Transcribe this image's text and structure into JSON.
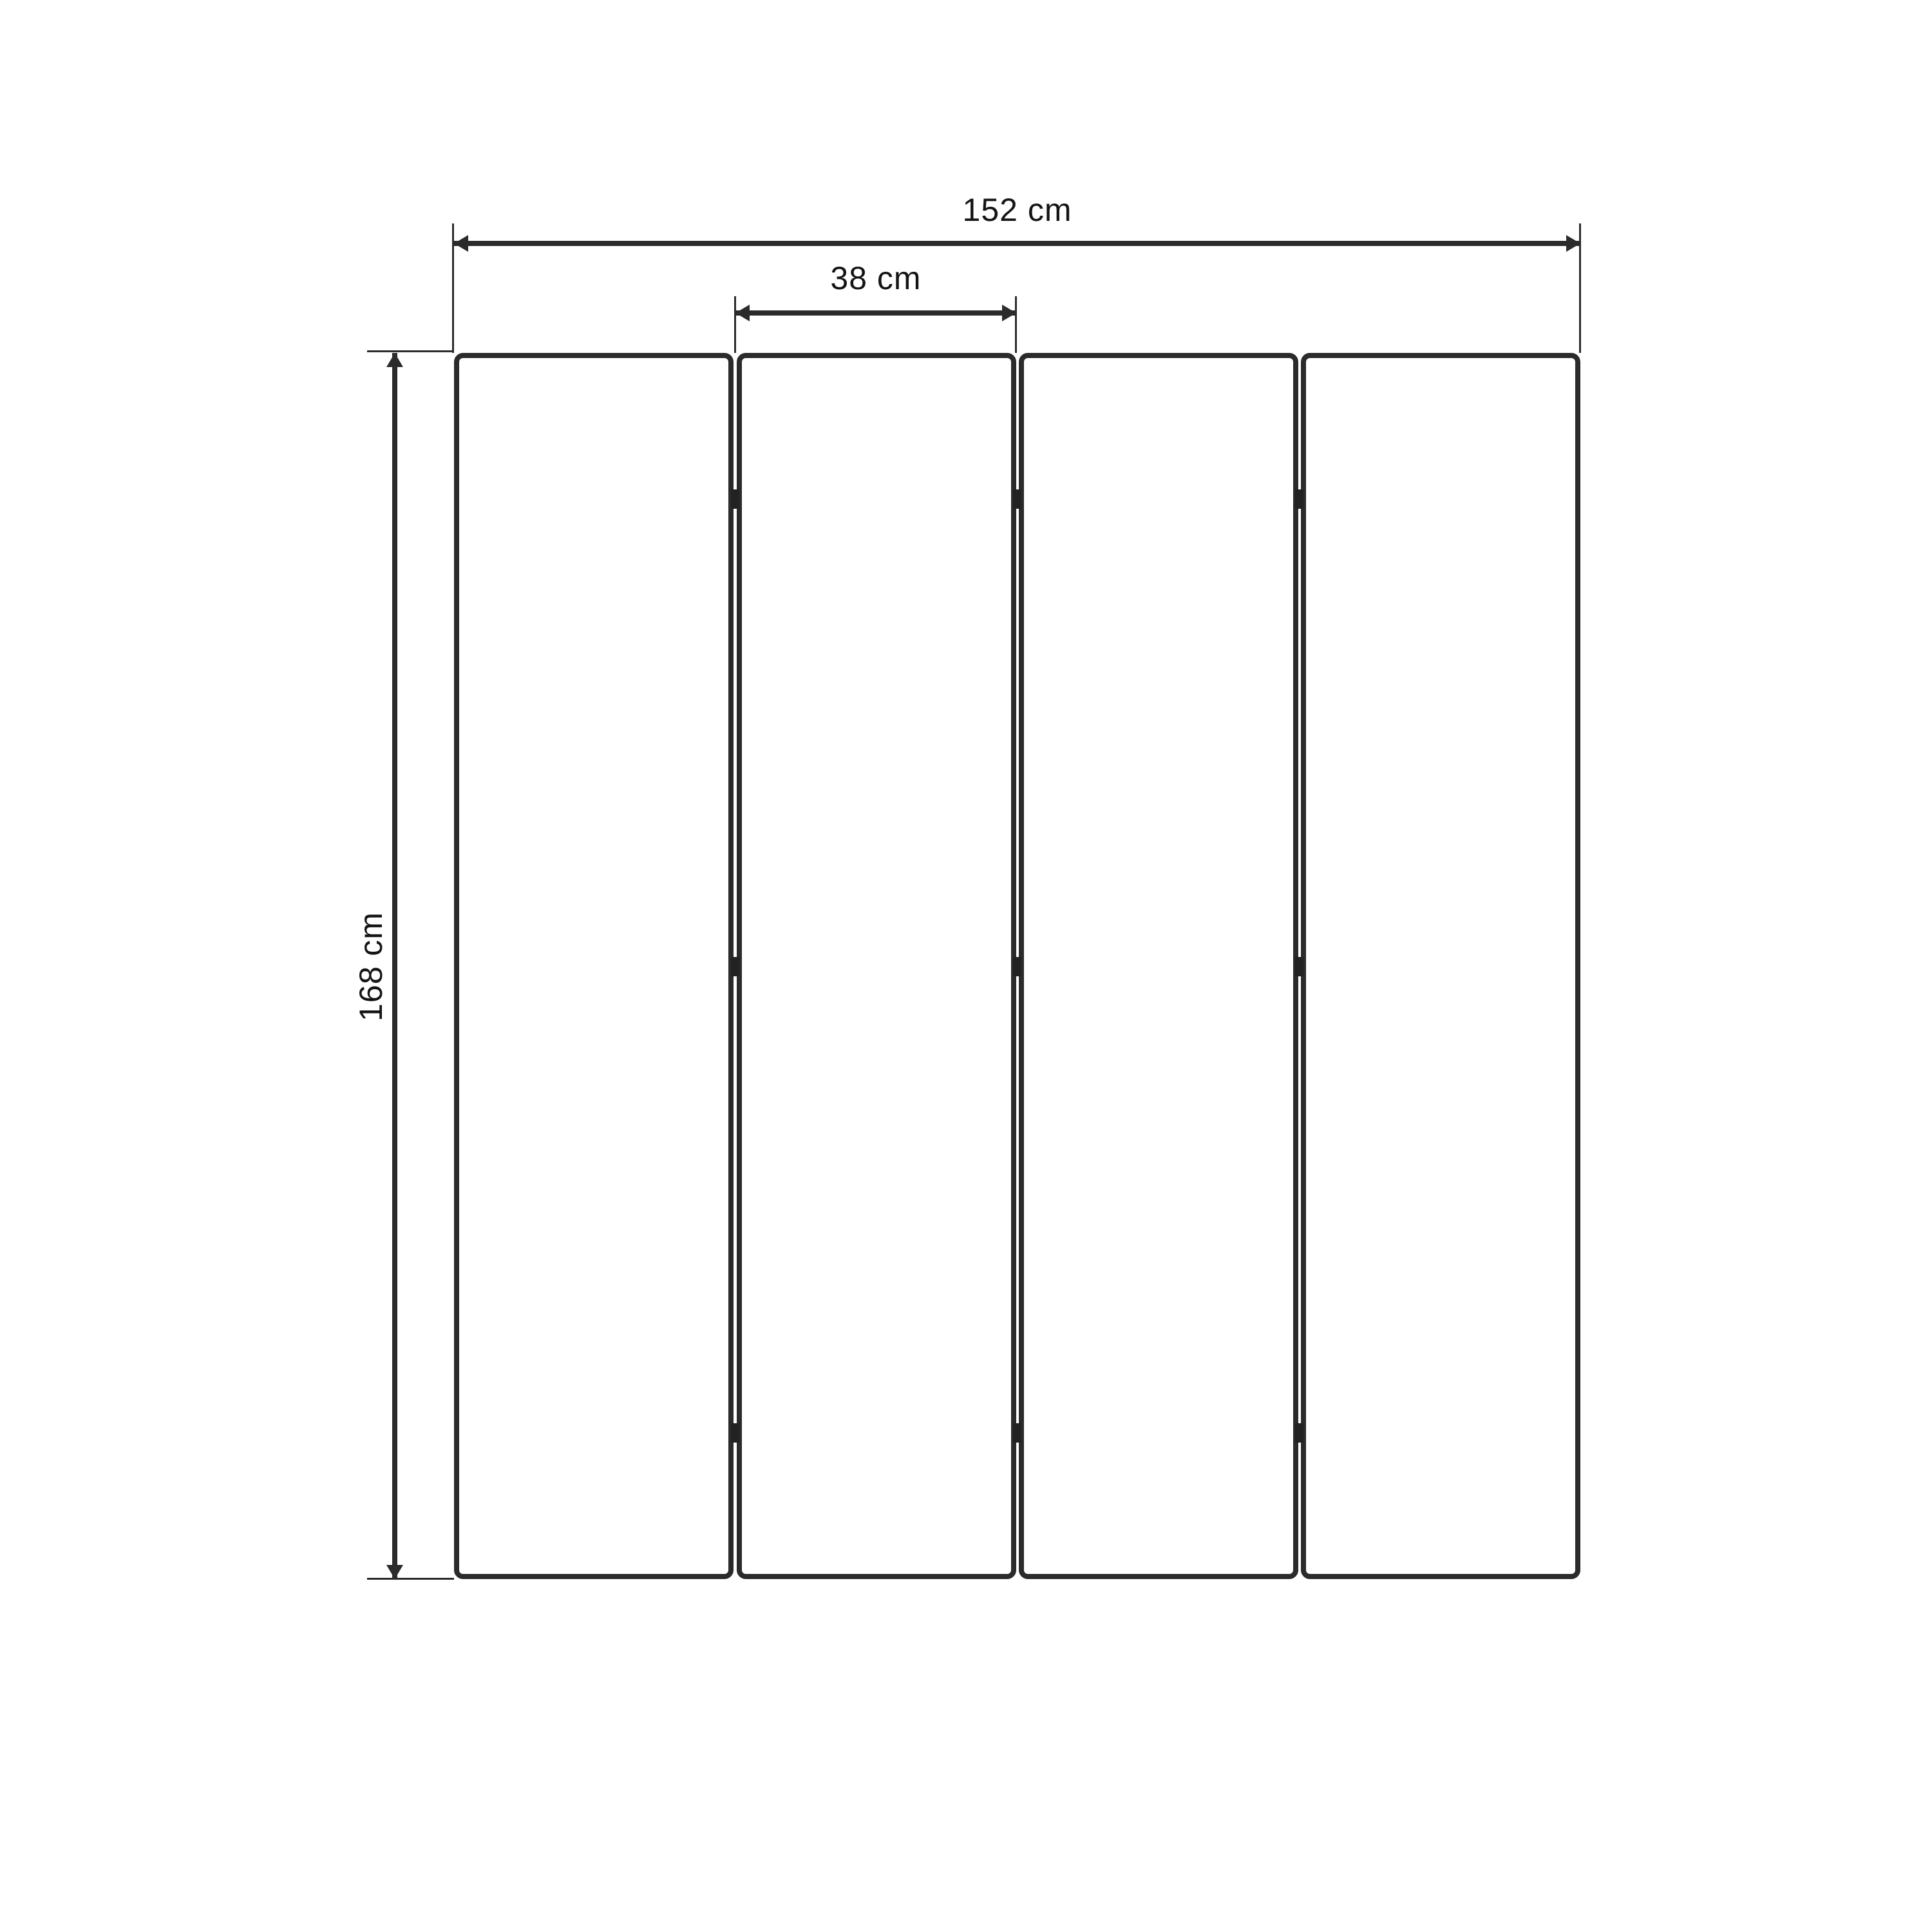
{
  "diagram": {
    "type": "folding-screen-dimension-drawing",
    "panel_count": 4,
    "labels": {
      "total_width": "152 cm",
      "panel_width": "38 cm",
      "height": "168 cm"
    },
    "measurements": {
      "total_width_cm": 152,
      "panel_width_cm": 38,
      "height_cm": 168
    },
    "colors": {
      "background": "#ffffff",
      "line": "#2b2b2b",
      "hinge": "#222222",
      "text": "#141414"
    }
  }
}
